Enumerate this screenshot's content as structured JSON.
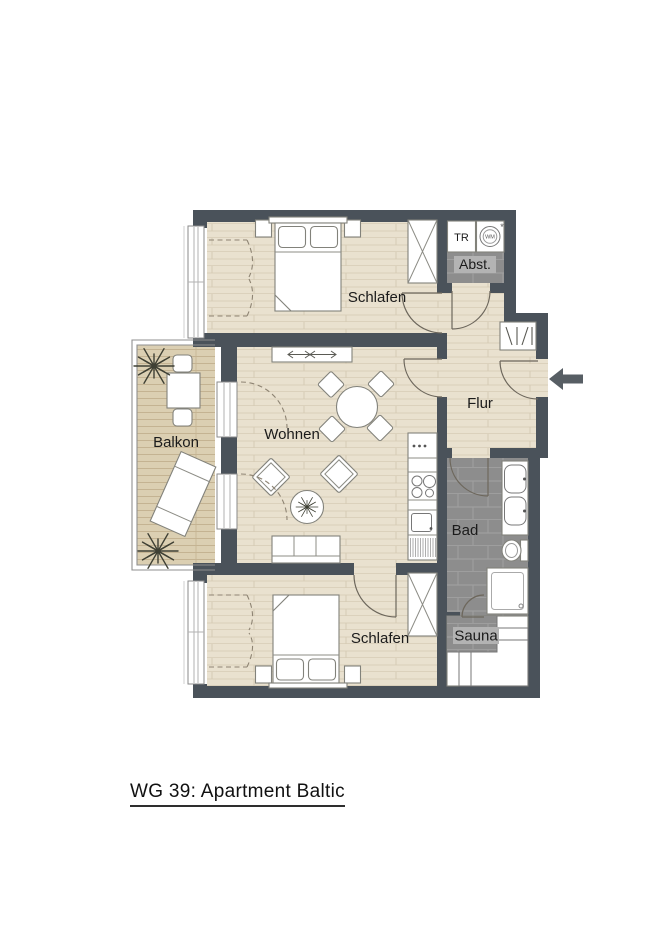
{
  "title": {
    "text": "WG 39: Apartment Baltic"
  },
  "plan": {
    "rooms": {
      "schlafen_top": "Schlafen",
      "schlafen_bottom": "Schlafen",
      "wohnen": "Wohnen",
      "balkon": "Balkon",
      "flur": "Flur",
      "bad": "Bad",
      "sauna": "Sauna",
      "abstellraum": "Abst."
    },
    "appliances": {
      "dryer_label": "TR",
      "washer_label": "WM",
      "washer_note": "*"
    },
    "icons": {
      "entry_arrow": "arrow-left",
      "plants": "plant-starburst"
    },
    "colors": {
      "wall": "#4a525a",
      "wood_floor": "#e9e1cf",
      "balcony_deck": "#dbcfb2",
      "tile": "#8d8d8d",
      "label_chip": "#b3b3b3",
      "arrow": "#575e64"
    }
  }
}
